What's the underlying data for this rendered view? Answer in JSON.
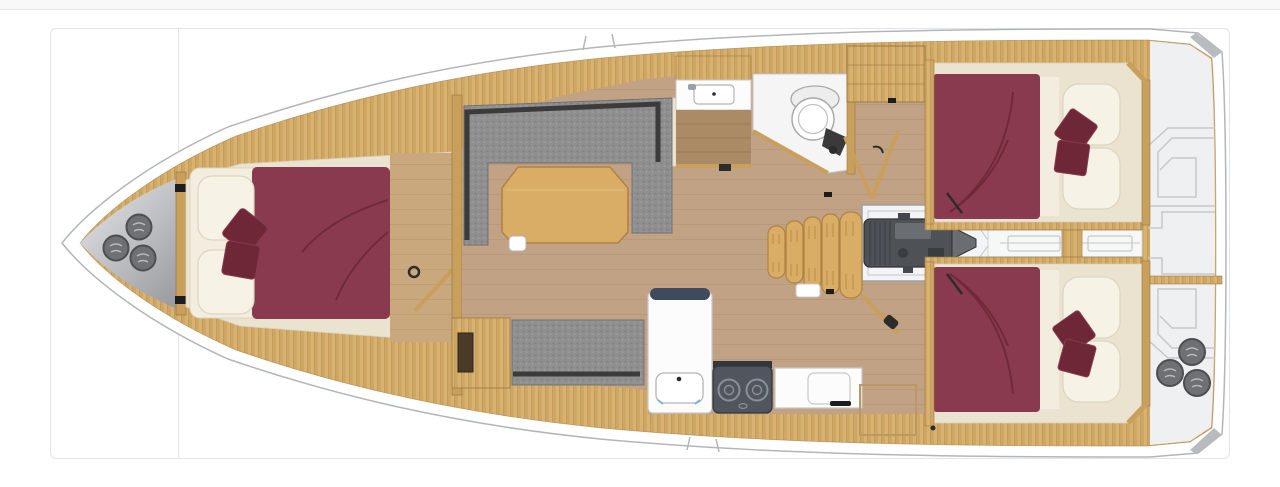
{
  "page": {
    "background": "#ffffff",
    "top_strip": "#f8f8f8",
    "strip_border": "#e7e7e7",
    "card_border": "#e4e4e6"
  },
  "figure": {
    "type": "sailing-yacht-interior-floor-plan",
    "view": "top-down",
    "orientation": "bow-left",
    "cabins": 3,
    "double_berths": 3,
    "bow_hatches": 3,
    "stern_winches": 3,
    "stove_burners": 2,
    "companionway_steps": 5
  },
  "areas": [
    {
      "id": "bow-sail-locker",
      "label": "Bow sail locker with three hatches"
    },
    {
      "id": "forward-cabin",
      "label": "Forward double cabin with maroon bedding"
    },
    {
      "id": "saloon",
      "label": "Saloon with U-shaped grey sofa and wood table"
    },
    {
      "id": "settee",
      "label": "Starboard side settee"
    },
    {
      "id": "galley",
      "label": "Galley with sink, two-burner stove and counter"
    },
    {
      "id": "head",
      "label": "Head compartment with sink and toilet"
    },
    {
      "id": "wardrobe",
      "label": "Wardrobe locker"
    },
    {
      "id": "companionway",
      "label": "Companionway steps"
    },
    {
      "id": "engine-room",
      "label": "Engine compartment"
    },
    {
      "id": "steering-channel",
      "label": "Stern drive channel"
    },
    {
      "id": "aft-cabin-port",
      "label": "Aft double cabin port side"
    },
    {
      "id": "aft-cabin-starboard",
      "label": "Aft double cabin starboard side"
    },
    {
      "id": "stern-cockpit",
      "label": "Stern with cockpit outlines and winches"
    }
  ],
  "plan": {
    "colors": {
      "hull_fill": "#ffffff",
      "hull_stroke": "#b3b6b9",
      "deck_wood": "#d8b271",
      "deck_wood_stripe": "#c79a55",
      "deck_wood_line": "#a87f42",
      "wall_wood": "#c99f5c",
      "wall_stroke": "#9a7a42",
      "floor": "#c2a284",
      "floor_line": "#ab8668",
      "cabin_floor": "#c9a87d",
      "cream": "#eae3d0",
      "cream_stroke": "#d8d2bf",
      "mattress": "#f2edde",
      "pillow": "#f6f2e6",
      "pillow_stroke": "#dcd5c0",
      "maroon": "#8a3a4e",
      "maroon_dark": "#6d2737",
      "sofa_gray": "#8f8f90",
      "sofa_speck_dark": "#7c7c7e",
      "sofa_speck_light": "#a3a3a5",
      "sofa_dark": "#3b3b3c",
      "sofa_stroke": "#6f6f70",
      "table_wood": "#d9ad65",
      "table_stroke": "#b08242",
      "counter_white": "#fcfcfc",
      "counter_stroke": "#c8c8c8",
      "counter_cap": "#3f4a5e",
      "basin_stroke": "#b5b5b5",
      "stove": "#50555e",
      "stove_dark": "#33363c",
      "burner": "#8a9099",
      "engine": "#4e5257",
      "engine_dark": "#2f3237",
      "engine_light": "#6a6e73",
      "engine_bay": "#f3f4f5",
      "bay_stroke": "#9aa0a6",
      "locker_light": "#e9e9eb",
      "locker_dark": "#9b9da1",
      "hatch_fill": "#6f7073",
      "hatch_stroke": "#4d4e51",
      "hatch_glyph": "#b9b9b9",
      "stern_fill": "#eef0f1",
      "stern_line": "#c6c8ca",
      "bevel": "#b9bcbe",
      "head_white": "#f5f5f5",
      "head_floor": "#ab8a66",
      "head_floor_line": "#8f7052",
      "porcelain": "#ffffff",
      "porcelain_stroke": "#a9a9a9",
      "fixture_dark": "#3a3a3b",
      "accent_blue": "#7ab3d9",
      "black_mark": "#1d1d1d",
      "gray_mark": "#2c2c2c",
      "metal": "#9aa0a6"
    }
  }
}
